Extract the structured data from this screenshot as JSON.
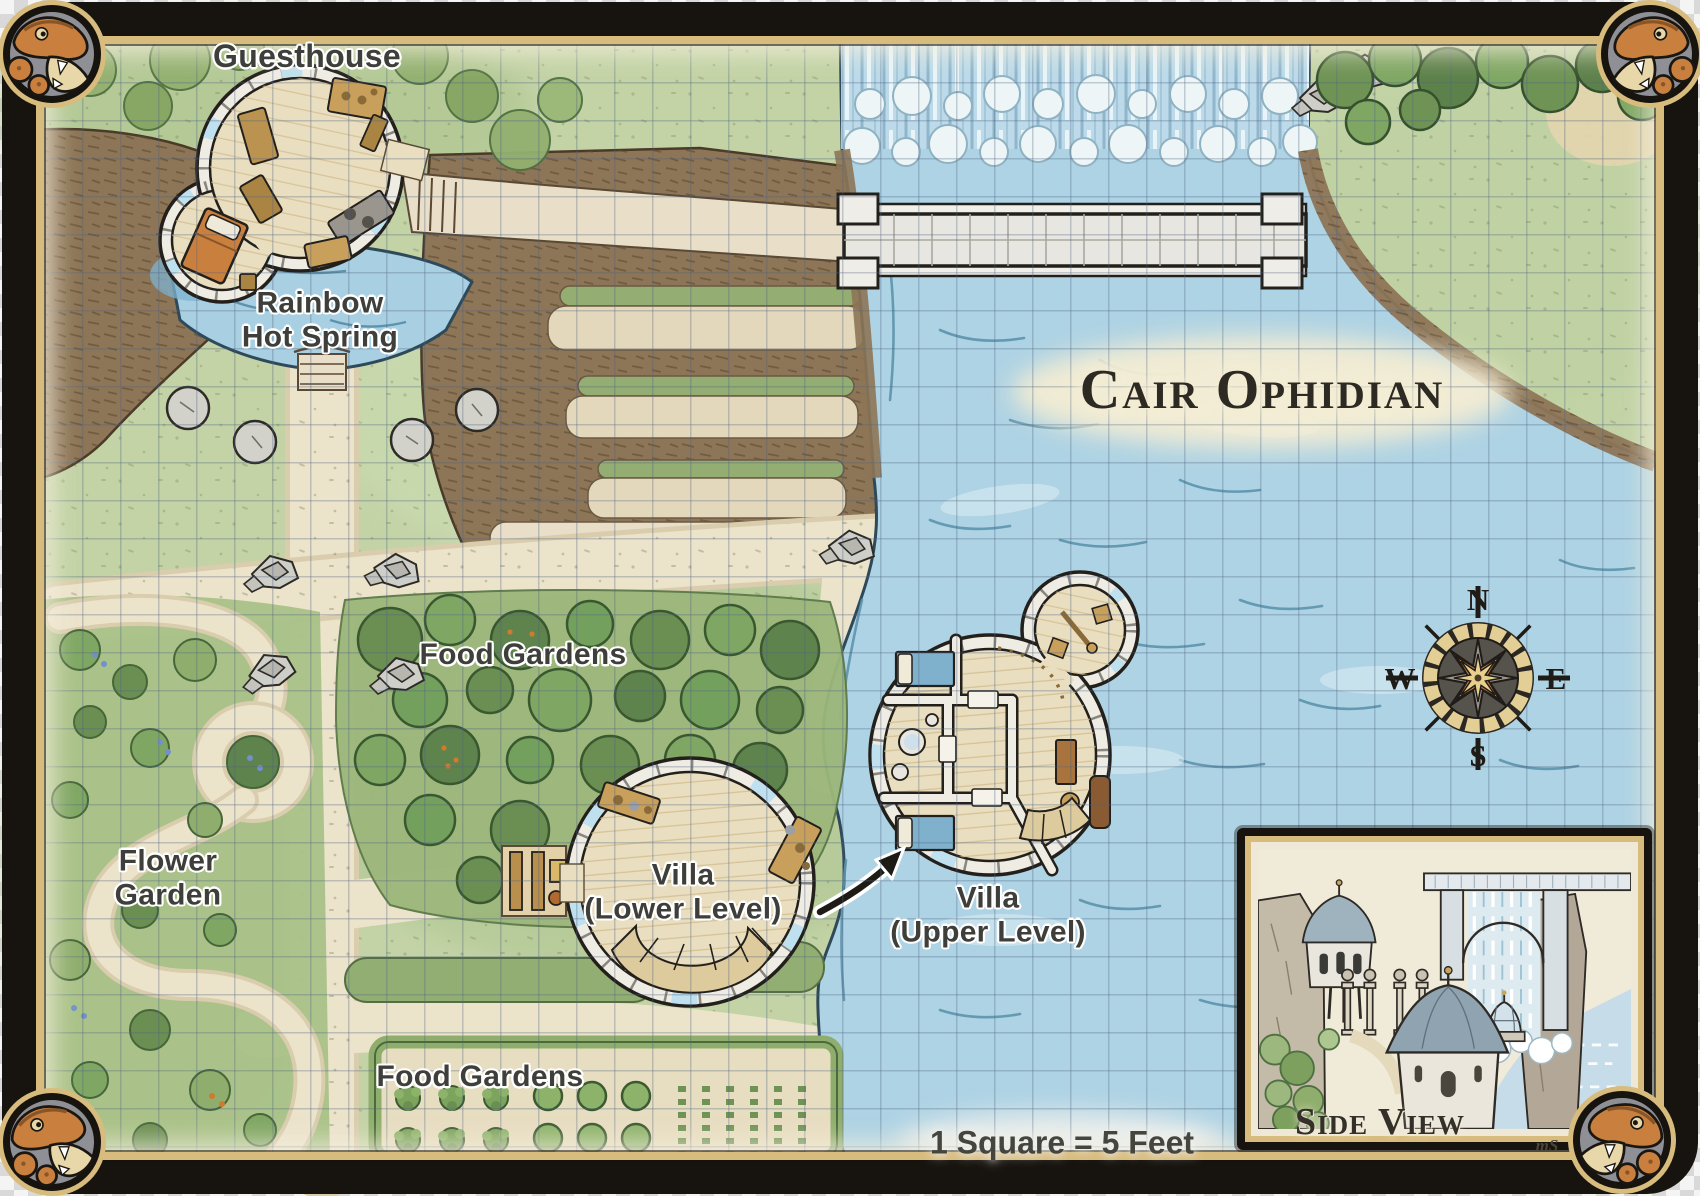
{
  "title": "Cair Ophidian",
  "scale_note": "1 Square = 5 Feet",
  "signature": "mS",
  "labels": {
    "guesthouse": "Guesthouse",
    "hot_spring": "Rainbow\nHot Spring",
    "food_gardens_upper": "Food Gardens",
    "flower_garden": "Flower\nGarden",
    "villa_lower": "Villa\n(Lower Level)",
    "villa_upper": "Villa\n(Upper Level)",
    "food_gardens_lower": "Food Gardens",
    "side_view": "Side View"
  },
  "compass": {
    "north": "N",
    "east": "E",
    "south": "S",
    "west": "W"
  },
  "icons": {
    "compass_rose": "compass-rose",
    "corner_medallions": "snake-head",
    "pointer": "curved-arrow"
  },
  "colors": {
    "frame": "#17130e",
    "gold": "#d8bc7e",
    "water": "#aed3e4",
    "grass": "#c3d3a6",
    "path": "#ece3cb",
    "cliff": "#8d7557",
    "tree": "#6b8f52",
    "snake": "#c9803f",
    "label_ink": "#3e3e3a"
  }
}
